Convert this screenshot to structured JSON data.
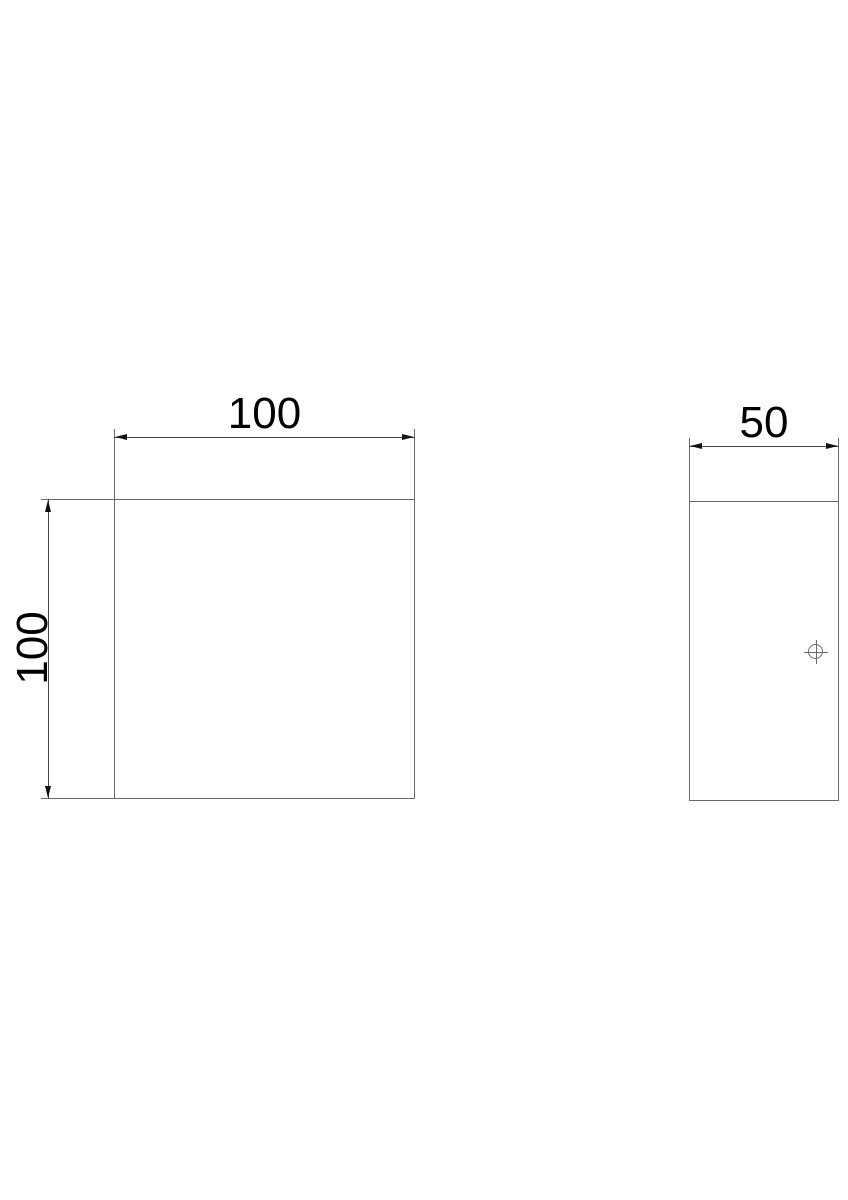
{
  "drawing": {
    "type": "technical-dimension-drawing",
    "front_view": {
      "width_label": "100",
      "height_label": "100"
    },
    "side_view": {
      "width_label": "50",
      "marks": [
        "center-mark"
      ]
    }
  },
  "colors": {
    "line": "#6a6a6a",
    "dim": "#454545",
    "arrow": "#111111",
    "text": "#000000",
    "background": "#ffffff"
  }
}
